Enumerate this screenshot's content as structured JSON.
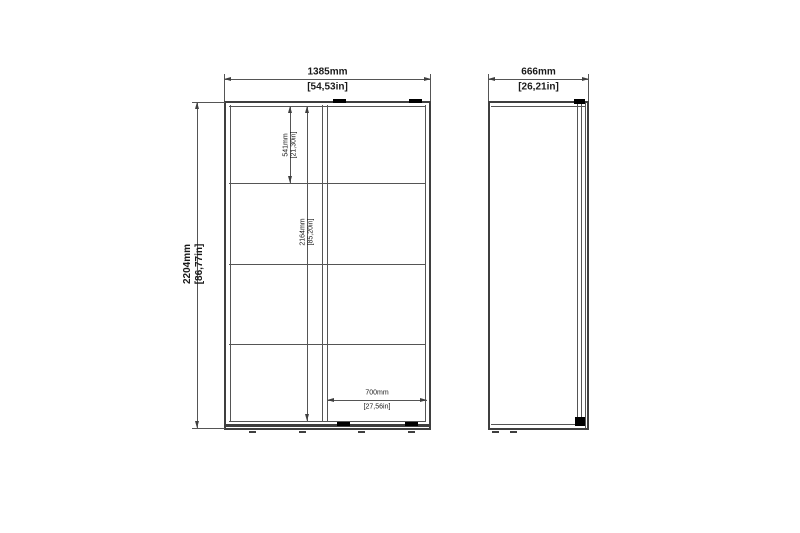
{
  "front_view": {
    "width_mm": "1385mm",
    "width_in": "[54,53in]",
    "height_mm": "2204mm",
    "height_in": "[86,77in]",
    "top_shelf_mm": "541mm",
    "top_shelf_in": "[21,30in]",
    "interior_height_mm": "2164mm",
    "interior_height_in": "[85,20in]",
    "door_width_mm": "700mm",
    "door_width_in": "[27,56in]"
  },
  "side_view": {
    "depth_mm": "666mm",
    "depth_in": "[26,21in]"
  },
  "colors": {
    "line": "#3f3f3f",
    "text": "#1a1a1a",
    "accent_black": "#000000",
    "background": "#ffffff"
  }
}
